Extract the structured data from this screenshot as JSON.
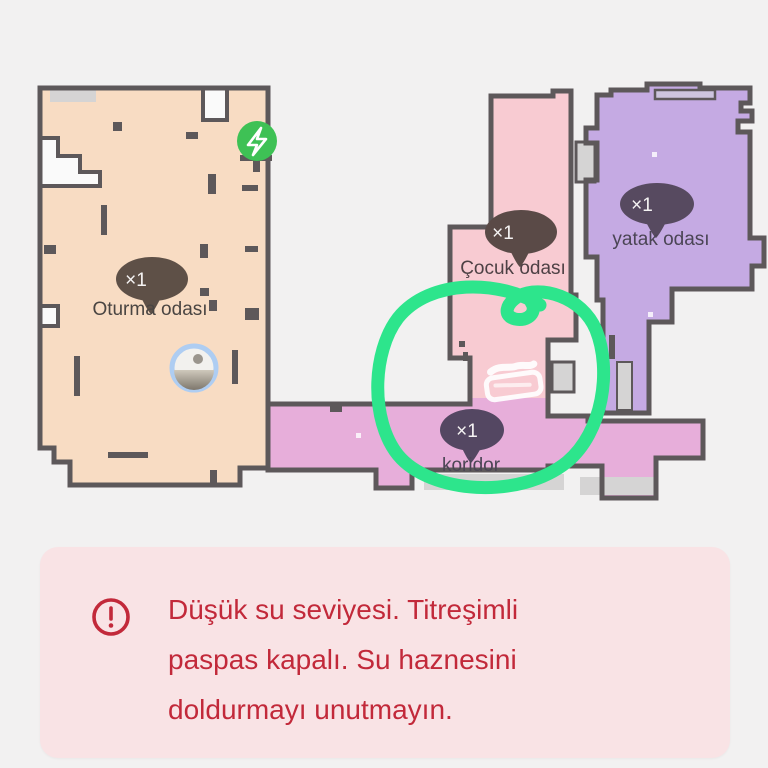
{
  "map": {
    "rooms": [
      {
        "id": "oturma-odasi",
        "label": "Oturma odası",
        "count": "×1",
        "fill": "#f8dcc3",
        "bubble_color": "#5e5047",
        "label_color": "#4a4542"
      },
      {
        "id": "cocuk-odasi",
        "label": "Çocuk odası",
        "count": "×1",
        "fill": "#f8cbd2",
        "bubble_color": "#5a4a47",
        "label_color": "#4e4145"
      },
      {
        "id": "yatak-odasi",
        "label": "yatak odası",
        "count": "×1",
        "fill": "#c5aae3",
        "bubble_color": "#574a60",
        "label_color": "#4b4555"
      },
      {
        "id": "koridor",
        "label": "koridor",
        "count": "×1",
        "fill": "#e7aeda",
        "bubble_color": "#544762",
        "label_color": "#4b4555"
      }
    ],
    "wall_color": "#5d585a",
    "annotation_color": "#2de58c",
    "charger_color": "#3ec155",
    "icons": {
      "charger": "lightning-bolt-in-green-circle",
      "robot": "robot-vacuum-position",
      "mop": "mop-zigzag-zone",
      "annotation": "hand-drawn-green-circle"
    }
  },
  "alert": {
    "icon": "exclamation-circle",
    "icon_color": "#c2293a",
    "bg_color": "#f9e3e5",
    "lines": [
      "Düşük su seviyesi. Titreşimli",
      "paspas kapalı. Su haznesini",
      "doldurmayı unutmayın."
    ]
  }
}
